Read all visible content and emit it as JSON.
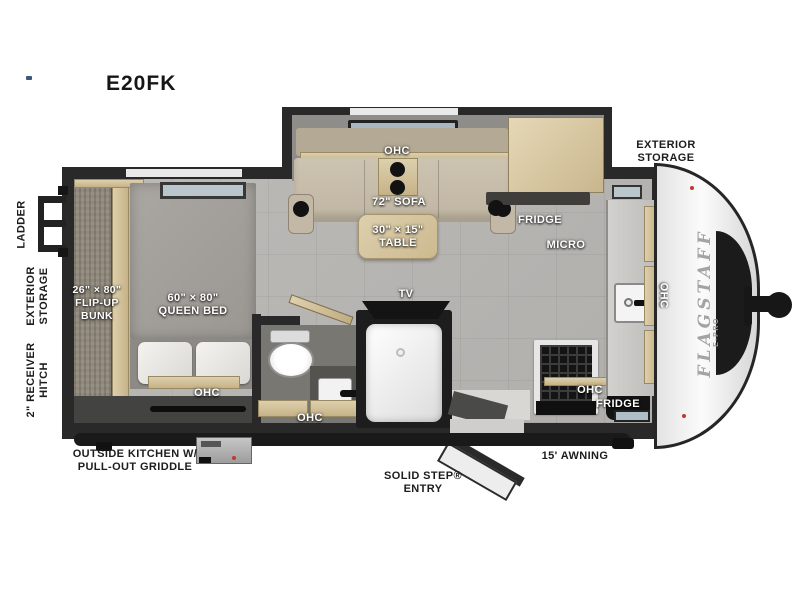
{
  "title": "E20FK",
  "brand": {
    "name": "FLAGSTAFF",
    "sub": "E-PRO"
  },
  "exterior": {
    "ladder": "LADDER",
    "rear_storage": [
      "EXTERIOR",
      "STORAGE"
    ],
    "hitch": [
      "2\" RECEIVER",
      "HITCH"
    ],
    "front_storage": [
      "EXTERIOR",
      "STORAGE"
    ],
    "outside_kitchen": [
      "OUTSIDE KITCHEN W/",
      "PULL-OUT GRIDDLE"
    ],
    "entry": [
      "SOLID STEP®",
      "ENTRY"
    ],
    "awning": "15' AWNING"
  },
  "interior": {
    "slide_ohc": "OHC",
    "sofa": "72\" SOFA",
    "table": [
      "30\" × 15\"",
      "TABLE"
    ],
    "fridge_upper": "FRIDGE",
    "micro": "MICRO",
    "front_ohc": "OHC",
    "bunk": [
      "26\" × 80\"",
      "FLIP-UP",
      "BUNK"
    ],
    "bed": [
      "60\" × 80\"",
      "QUEEN BED"
    ],
    "bed_ohc": "OHC",
    "tv": "TV",
    "bath_ohc": "OHC",
    "kitchen_ohc": "OHC",
    "kitchen_fridge": "FRIDGE"
  },
  "colors": {
    "wall": "#292929",
    "floor": "#b7b5b2",
    "wood": "#d3c29c",
    "sofa": "#c8bead",
    "front_cap": "#f2f2f2",
    "label_dark": "#1c1c1c",
    "label_light": "#ffffff"
  }
}
